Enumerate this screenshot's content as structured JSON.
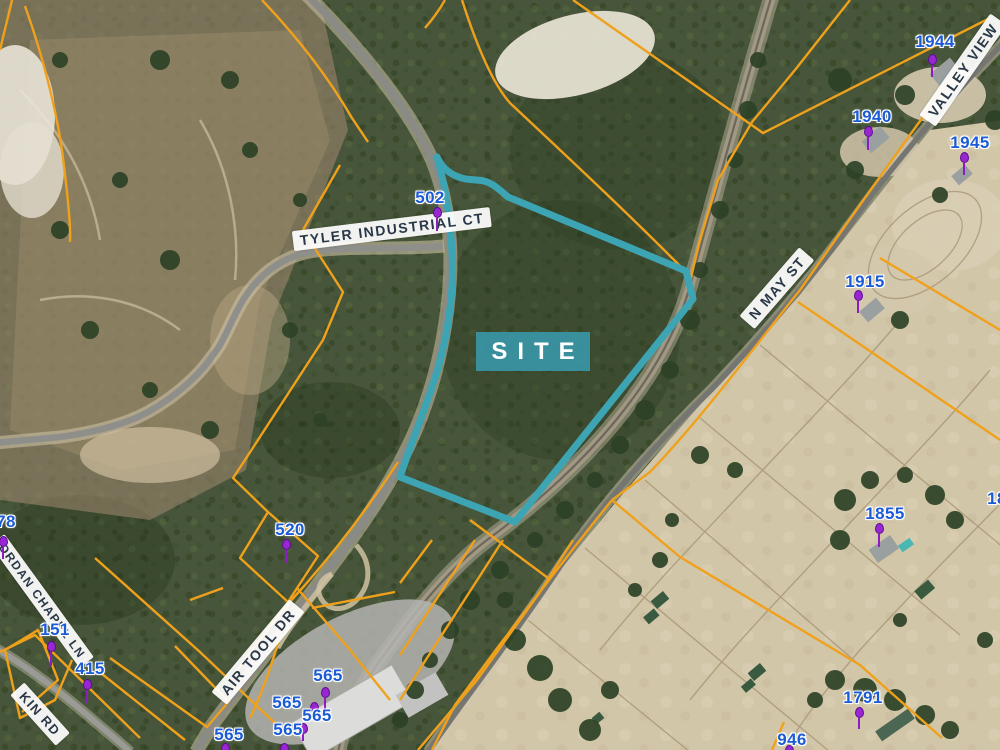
{
  "map": {
    "site_label": "SITE",
    "colors": {
      "parcel_line": "#efa11c",
      "site_outline": "#3da4b4",
      "site_box": "#3992a2",
      "address_text": "#1b5cd6",
      "pin": "#9a25d2",
      "street_text": "#2a3848"
    },
    "street_labels": [
      {
        "text": "TYLER INDUSTRIAL CT",
        "x": 392,
        "y": 229,
        "rot": -7,
        "size": 14
      },
      {
        "text": "AIR TOOL DR",
        "x": 258,
        "y": 652,
        "rot": -50,
        "size": 14
      },
      {
        "text": "N MAY ST",
        "x": 777,
        "y": 288,
        "rot": -49,
        "size": 14
      },
      {
        "text": "VALLEY VIEW",
        "x": 963,
        "y": 70,
        "rot": -55,
        "size": 14
      },
      {
        "text": "ORDAN CHAPEL LN",
        "x": 42,
        "y": 601,
        "rot": 54,
        "size": 12
      },
      {
        "text": "KIN RD",
        "x": 40,
        "y": 714,
        "rot": 48,
        "size": 13
      }
    ],
    "addresses": [
      {
        "text": "502",
        "x": 430,
        "y": 198
      },
      {
        "text": "78",
        "x": 6,
        "y": 522
      },
      {
        "text": "151",
        "x": 55,
        "y": 630
      },
      {
        "text": "415",
        "x": 90,
        "y": 669
      },
      {
        "text": "520",
        "x": 290,
        "y": 530
      },
      {
        "text": "565",
        "x": 328,
        "y": 676
      },
      {
        "text": "565",
        "x": 287,
        "y": 703
      },
      {
        "text": "565",
        "x": 317,
        "y": 716
      },
      {
        "text": "565",
        "x": 288,
        "y": 730
      },
      {
        "text": "565",
        "x": 229,
        "y": 735
      },
      {
        "text": "1944",
        "x": 935,
        "y": 42
      },
      {
        "text": "1940",
        "x": 872,
        "y": 117
      },
      {
        "text": "1945",
        "x": 970,
        "y": 143
      },
      {
        "text": "1915",
        "x": 865,
        "y": 282
      },
      {
        "text": "1855",
        "x": 885,
        "y": 514
      },
      {
        "text": "1791",
        "x": 863,
        "y": 698
      },
      {
        "text": "946",
        "x": 792,
        "y": 740
      },
      {
        "text": "18",
        "x": 997,
        "y": 499
      }
    ],
    "pins": [
      {
        "x": 437,
        "y": 211,
        "stem": 13
      },
      {
        "x": 3,
        "y": 540,
        "stem": 12
      },
      {
        "x": 51,
        "y": 645,
        "stem": 14
      },
      {
        "x": 87,
        "y": 683,
        "stem": 13
      },
      {
        "x": 286,
        "y": 543,
        "stem": 13
      },
      {
        "x": 325,
        "y": 691,
        "stem": 11
      },
      {
        "x": 314,
        "y": 706,
        "stem": 7
      },
      {
        "x": 303,
        "y": 727,
        "stem": 7
      },
      {
        "x": 284,
        "y": 747,
        "stem": 9
      },
      {
        "x": 225,
        "y": 747,
        "stem": 9
      },
      {
        "x": 932,
        "y": 58,
        "stem": 12
      },
      {
        "x": 868,
        "y": 130,
        "stem": 13
      },
      {
        "x": 964,
        "y": 156,
        "stem": 12
      },
      {
        "x": 858,
        "y": 294,
        "stem": 12
      },
      {
        "x": 879,
        "y": 527,
        "stem": 13
      },
      {
        "x": 859,
        "y": 711,
        "stem": 11
      },
      {
        "x": 789,
        "y": 749,
        "stem": 6
      }
    ]
  }
}
